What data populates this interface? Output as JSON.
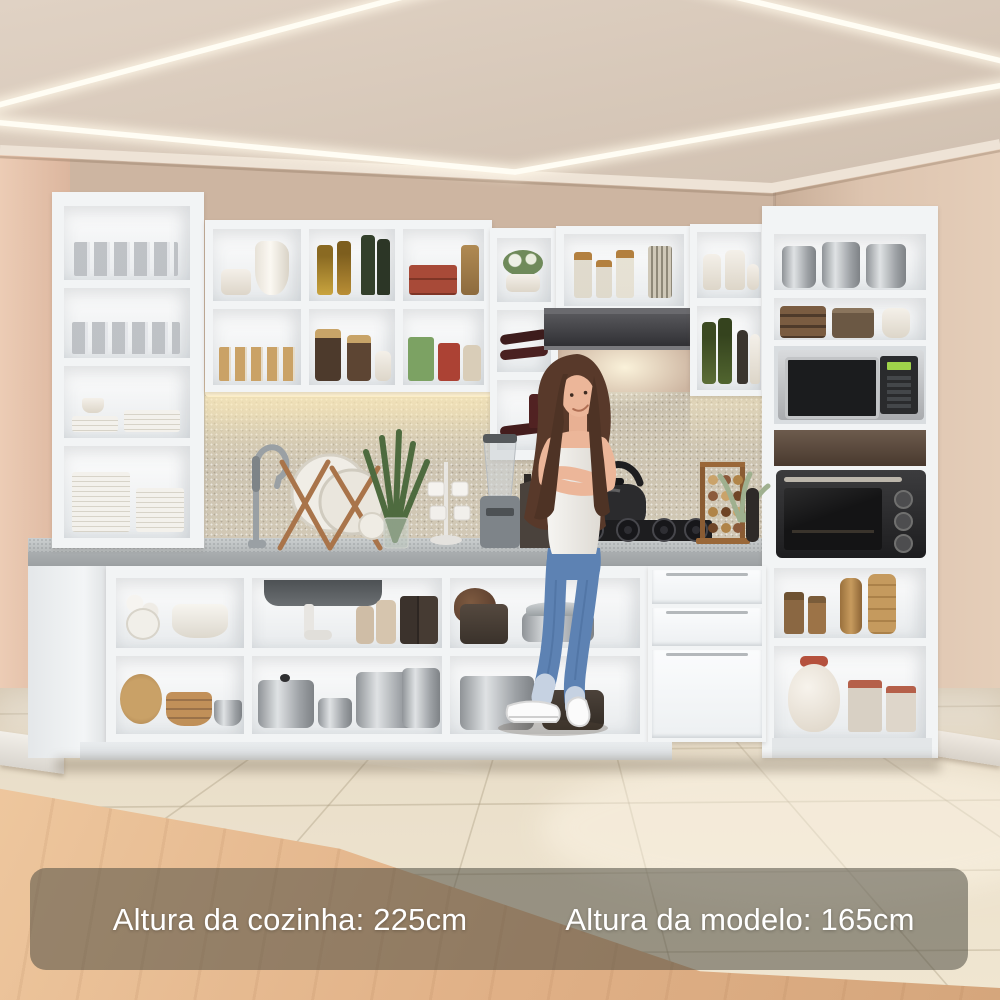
{
  "meta": {
    "type": "product-photo",
    "subject": "White L-shaped modular kitchen with open shelves, appliances and a model standing in front"
  },
  "captions": {
    "kitchen_height": "Altura da cozinha: 225cm",
    "model_height": "Altura da modelo: 165cm"
  },
  "palette": {
    "cabinet_white": "#f2f4f5",
    "countertop_gray": "#b7bbbc",
    "backsplash_beige": "#cdc4b2",
    "wall_beige": "#c9ad97",
    "left_wall_pink": "#e3bfa9",
    "ceiling_beige": "#d8c9bb",
    "led_light": "#fffdf4",
    "hood_dark": "#3a3a3c",
    "floor_tile": "#e9dfca",
    "wood_floor": "#e2b58c",
    "overlay": "rgba(80,78,68,0.55)",
    "caption_text": "#ffffff",
    "jeans_blue": "#5d82b3",
    "hair_brown": "#58392a",
    "skin": "#ecb699",
    "tank_top": "#f2f0ec"
  }
}
